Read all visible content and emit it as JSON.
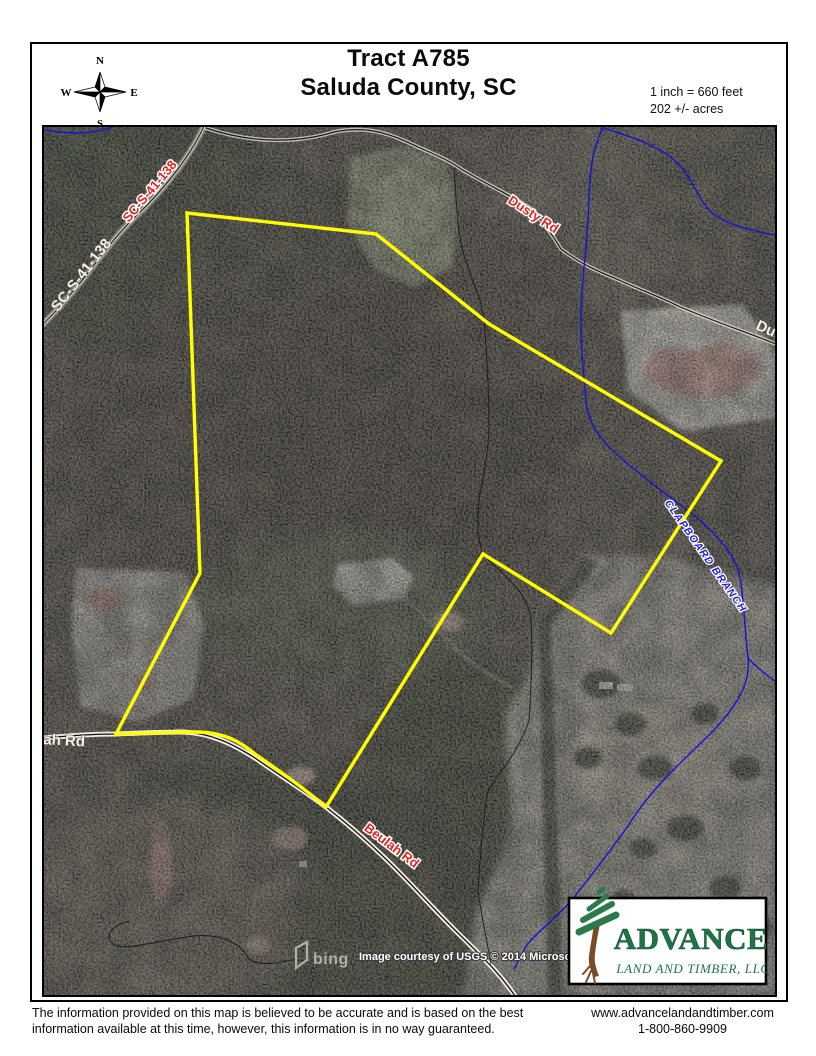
{
  "header": {
    "title_line1": "Tract A785",
    "title_line2": "Saluda County, SC",
    "scale": "1 inch = 660 feet",
    "acreage": "202 +/- acres"
  },
  "compass": {
    "north": "N",
    "east": "E",
    "south": "S",
    "west": "W"
  },
  "map": {
    "labels": {
      "road_sc": "SC-S-41-138",
      "road_sc_ghost": "SC-S-41-138",
      "road_dusty": "Dusty Rd",
      "road_dusty_ghost": "Dusty",
      "road_beulah": "Beulah Rd",
      "road_beulah_ghost": "lah Rd",
      "stream": "CLAPBOARD BRANCH"
    },
    "attribution": {
      "bing": "bing",
      "credit": "Image courtesy of USGS © 2014 Microsoft Corporation"
    },
    "colors": {
      "boundary": "#ffff00",
      "road_label_red": "#e02520",
      "stream_blue": "#1414d6",
      "stream_label_blue": "#1d1de0",
      "ghost_label": "#f5f2ea"
    }
  },
  "logo": {
    "name": "ADVANCE",
    "subtitle": "LAND AND TIMBER, LLC",
    "color": "#1e7446"
  },
  "footer": {
    "disclaimer_line1": "The information provided on this map is believed to be accurate and is based on the best",
    "disclaimer_line2": "information available at this time, however, this information is in no way guaranteed.",
    "website": "www.advancelandandtimber.com",
    "phone": "1-800-860-9909"
  }
}
